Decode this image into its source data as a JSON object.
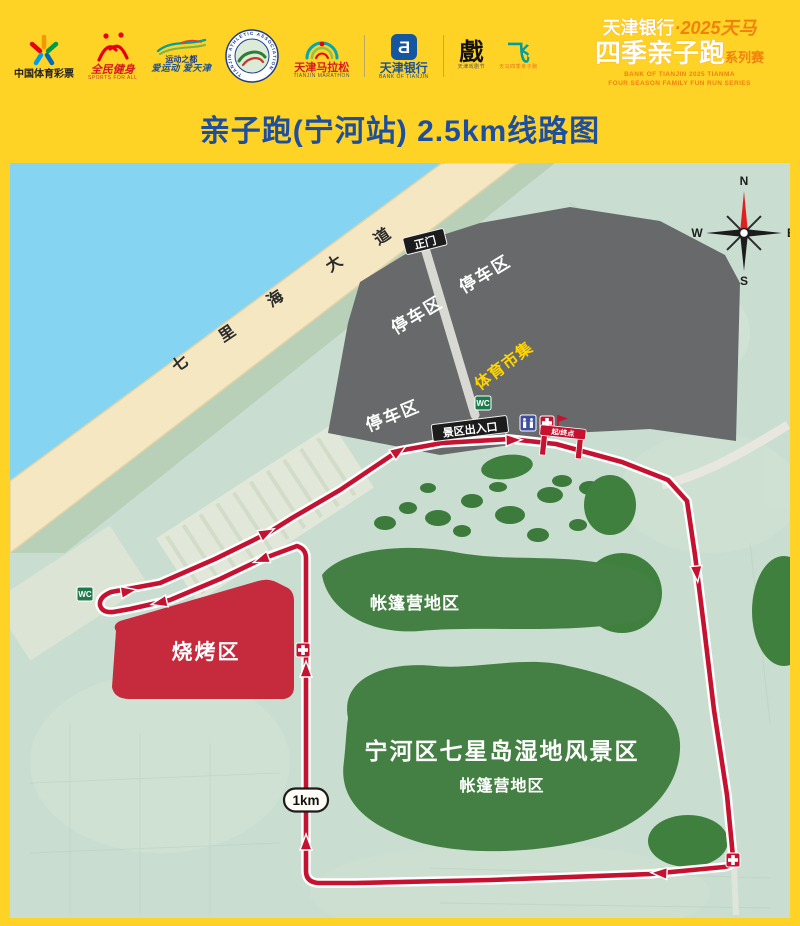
{
  "header": {
    "title": "亲子跑(宁河站) 2.5km线路图",
    "logos": {
      "lottery": {
        "label": "中国体育彩票"
      },
      "sports_for_all": {
        "label": "全民健身",
        "sub": "SPORTS FOR ALL"
      },
      "sport_city": {
        "label": "运动之都",
        "sub": "爱运动 爱天津"
      },
      "athletic_assoc": {
        "label": "TIANJIN ATHLETIC ASSOCIATION"
      },
      "marathon": {
        "label": "天津马拉松",
        "sub": "TIANJIN MARATHON"
      },
      "bank": {
        "glyph": "Ƌ",
        "label": "天津银行",
        "sub": "BANK OF TIANJIN"
      },
      "opera": {
        "glyph": "戲",
        "sub": "天津戏剧节"
      },
      "funrun": {
        "glyph": "飞",
        "sub": "天马四季亲子跑"
      }
    },
    "brand": {
      "line1_white": "天津银行",
      "line1_dot": "·",
      "line1_orange": "2025天马",
      "line2_main": "四季亲子跑",
      "line2_suffix": "系列赛",
      "eng1": "BANK OF TIANJIN   2025 TIANMA",
      "eng2": "FOUR  SEASON  FAMILY  FUN  RUN  SERIES"
    }
  },
  "map": {
    "road": {
      "chars": [
        "七",
        "里",
        "海",
        "大",
        "道"
      ]
    },
    "compass": {
      "n": "N",
      "e": "E",
      "s": "S",
      "w": "W"
    },
    "labels": {
      "gate": "正门",
      "parking1": "停车区",
      "parking2": "停车区",
      "parking3": "停车区",
      "market": "体育市集",
      "exit": "景区出入口",
      "start_finish": "起/终点",
      "wc1": "WC",
      "wc2": "WC",
      "bbq": "烧烤区",
      "camp_upper": "帐篷营地区",
      "scenic": "宁河区七星岛湿地风景区",
      "camp_lower": "帐篷营地区",
      "km_marker": "1km"
    },
    "colors": {
      "background_yellow": "#ffd226",
      "title_blue": "#1d4f9e",
      "route_red": "#c41230",
      "water_cyan": "#85d4f1",
      "road_beige": "#f4e7c2",
      "parking_gray": "#67696a",
      "bbq_red": "#c62a3d",
      "green_dark": "#3f7d3d",
      "map_bg_green": "#c9ded1",
      "market_yellow": "#ffd400"
    }
  }
}
